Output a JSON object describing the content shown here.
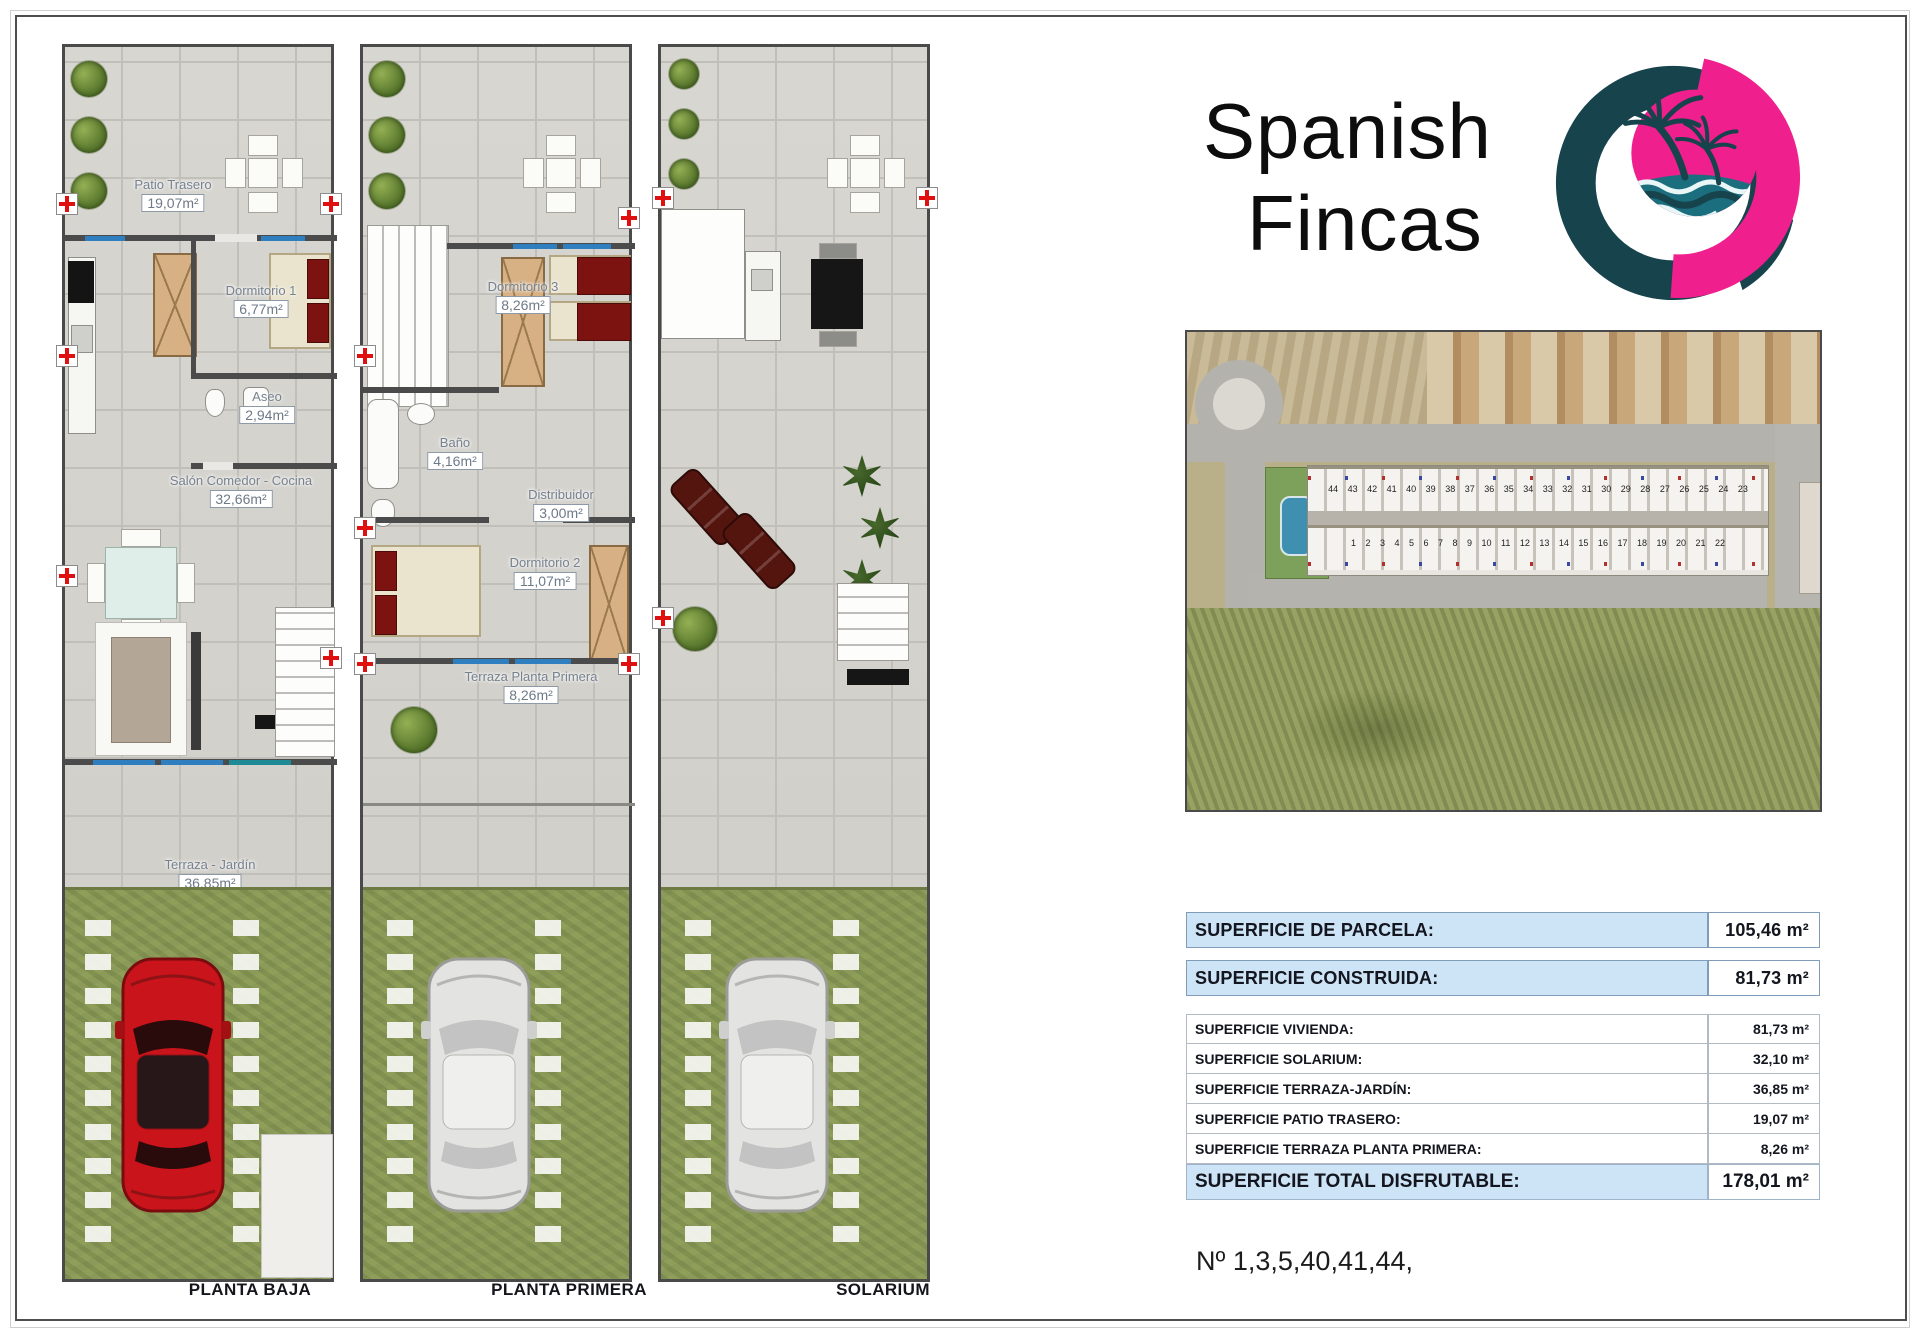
{
  "brand": {
    "line1": "Spanish",
    "line2": "Fincas"
  },
  "plans": [
    {
      "caption": "PLANTA BAJA",
      "rooms": [
        {
          "name": "Patio Trasero",
          "area": "19,07m²"
        },
        {
          "name": "Dormitorio 1",
          "area": "6,77m²"
        },
        {
          "name": "Aseo",
          "area": "2,94m²"
        },
        {
          "name": "Salón Comedor - Cocina",
          "area": "32,66m²"
        },
        {
          "name": "Terraza - Jardín",
          "area": "36,85m²"
        }
      ]
    },
    {
      "caption": "PLANTA PRIMERA",
      "rooms": [
        {
          "name": "Dormitorio 3",
          "area": "8,26m²"
        },
        {
          "name": "Baño",
          "area": "4,16m²"
        },
        {
          "name": "Distribuidor",
          "area": "3,00m²"
        },
        {
          "name": "Dormitorio 2",
          "area": "11,07m²"
        },
        {
          "name": "Terraza Planta Primera",
          "area": "8,26m²"
        }
      ]
    },
    {
      "caption": "SOLARIUM",
      "rooms": []
    }
  ],
  "aerial": {
    "top_row_numbers": "44 43 42 41 40 39 38 37 36 35 34 33 32 31 30 29 28 27 26 25 24 23",
    "bottom_row_numbers": "1 2 3 4 5 6 7 8 9 10 11 12 13 14 15 16 17 18 19 20 21 22"
  },
  "summary": {
    "parcela": {
      "label": "SUPERFICIE DE PARCELA:",
      "value": "105,46 m²"
    },
    "construida": {
      "label": "SUPERFICIE CONSTRUIDA:",
      "value": "81,73 m²"
    },
    "details": [
      {
        "label": "SUPERFICIE VIVIENDA:",
        "value": "81,73 m²"
      },
      {
        "label": "SUPERFICIE SOLARIUM:",
        "value": "32,10 m²"
      },
      {
        "label": "SUPERFICIE TERRAZA-JARDÍN:",
        "value": "36,85 m²"
      },
      {
        "label": "SUPERFICIE PATIO TRASERO:",
        "value": "19,07 m²"
      },
      {
        "label": "SUPERFICIE TERRAZA PLANTA PRIMERA:",
        "value": "8,26 m²"
      }
    ],
    "total": {
      "label": "SUPERFICIE TOTAL DISFRUTABLE:",
      "value": "178,01 m²"
    }
  },
  "footer_note": "Nº 1,3,5,40,41,44,",
  "colors": {
    "accent_pink": "#ef1f8d",
    "accent_teal": "#17434d",
    "table_header_bg": "#cde3f6",
    "table_border": "#7f9db9"
  }
}
